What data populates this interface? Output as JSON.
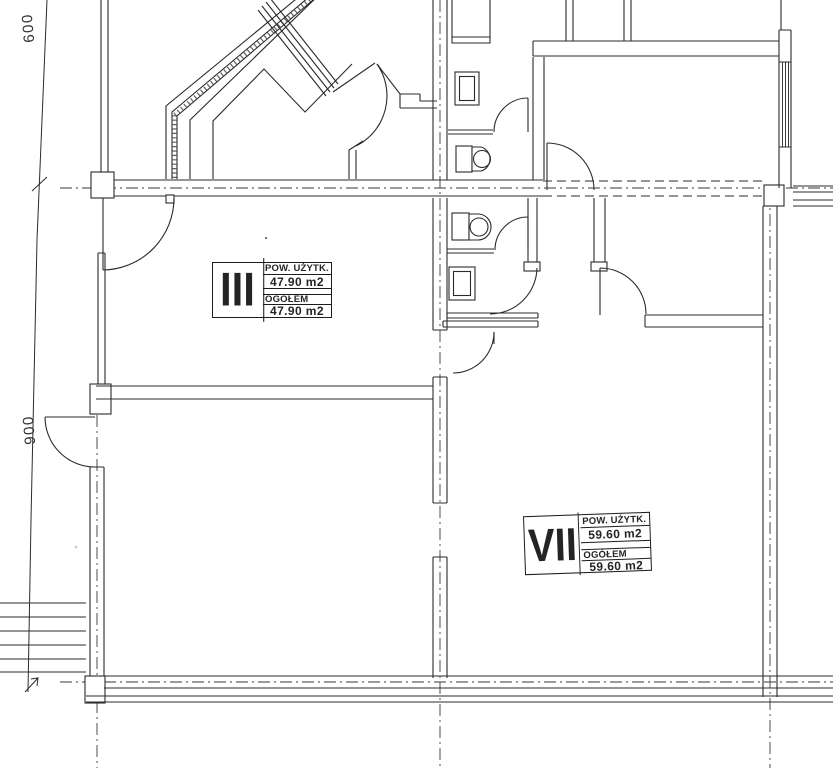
{
  "rooms": [
    {
      "numeral": "III",
      "area_label": "POW. UŻYTK.",
      "area_value": "47.90 m2",
      "total_label": "OGÓŁEM",
      "total_value": "47.90 m2"
    },
    {
      "numeral": "VII",
      "area_label": "POW. UŻYTK.",
      "area_value": "59.60 m2",
      "total_label": "OGÓŁEM",
      "total_value": "59.60 m2"
    }
  ],
  "dimensions": {
    "d600": "600",
    "d900": "900"
  }
}
